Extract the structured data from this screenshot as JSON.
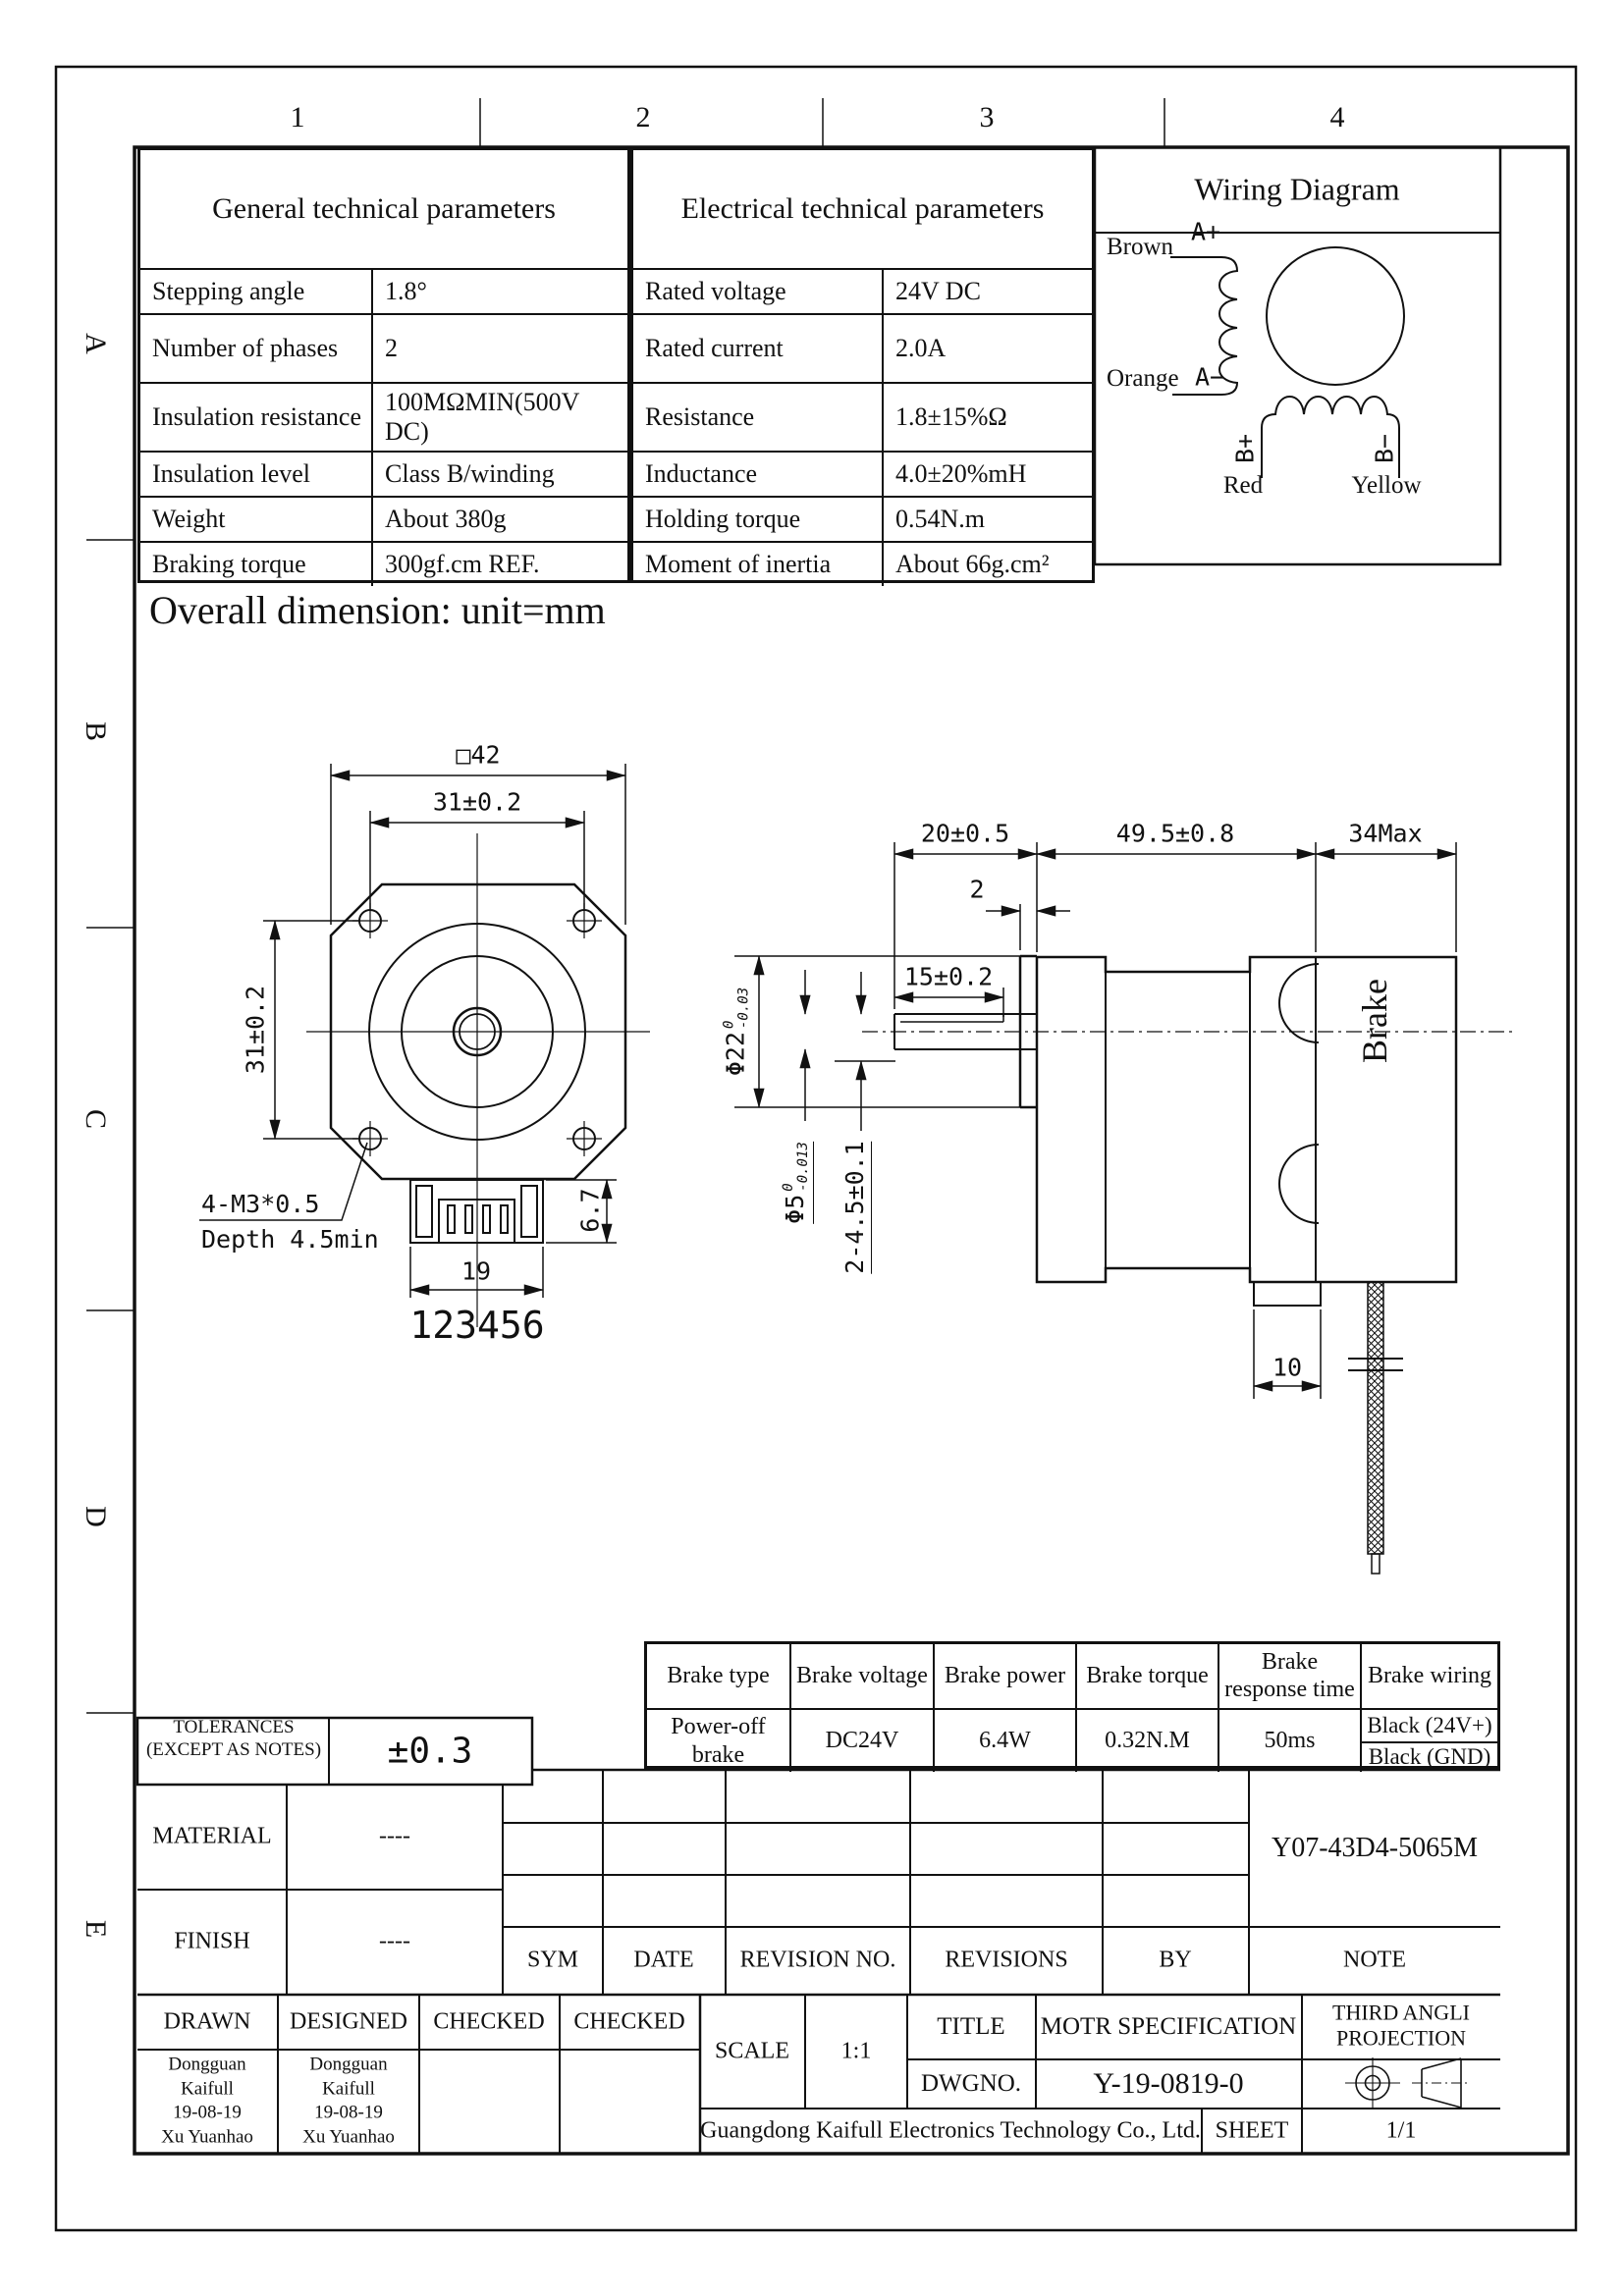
{
  "zones": {
    "cols": [
      "1",
      "2",
      "3",
      "4"
    ],
    "rows": [
      "A",
      "B",
      "C",
      "D",
      "E"
    ]
  },
  "general_table": {
    "title": "General technical parameters",
    "rows": [
      {
        "label": "Stepping angle",
        "value": "1.8°"
      },
      {
        "label": "Number of phases",
        "value": "2"
      },
      {
        "label": "Insulation resistance",
        "value": "100MΩMIN(500V DC)"
      },
      {
        "label": "Insulation level",
        "value": "Class B/winding"
      },
      {
        "label": "Weight",
        "value": "About 380g"
      },
      {
        "label": "Braking torque",
        "value": "300gf.cm REF."
      }
    ]
  },
  "electrical_table": {
    "title": "Electrical technical parameters",
    "rows": [
      {
        "label": "Rated voltage",
        "value": "24V DC"
      },
      {
        "label": "Rated current",
        "value": "2.0A"
      },
      {
        "label": "Resistance",
        "value": "1.8±15%Ω"
      },
      {
        "label": "Inductance",
        "value": "4.0±20%mH"
      },
      {
        "label": "Holding torque",
        "value": "0.54N.m"
      },
      {
        "label": "Moment of inertia",
        "value": "About 66g.cm²"
      }
    ]
  },
  "wiring": {
    "title": "Wiring Diagram",
    "brown": "Brown",
    "orange": "Orange",
    "red": "Red",
    "yellow": "Yellow",
    "a_plus": "A+",
    "a_minus": "A−",
    "b_plus": "B+",
    "b_minus": "B−"
  },
  "dims": {
    "heading": "Overall dimension: unit=mm",
    "front": {
      "square": "□42",
      "width_holes": "31±0.2",
      "height_holes": "31±0.2",
      "screw": "4-M3*0.5",
      "screw_depth": "Depth 4.5min",
      "conn_width": "19",
      "conn_height": "6.7",
      "pins": "123456"
    },
    "side": {
      "shaft_len": "20±0.5",
      "body_len": "49.5±0.8",
      "brake_len": "34Max",
      "boss_len": "2",
      "flat_len": "15±0.2",
      "boss_dia": "Φ22",
      "boss_dia_hi": "0",
      "boss_dia_lo": "-0.03",
      "shaft_dia": "Φ5",
      "shaft_dia_hi": "0",
      "shaft_dia_lo": "-0.013",
      "holes": "2-4.5±0.1",
      "wire_exit": "10",
      "brake_label": "Brake"
    }
  },
  "brake_table": {
    "headers": [
      "Brake type",
      "Brake voltage",
      "Brake power",
      "Brake torque",
      "Brake response time",
      "Brake wiring"
    ],
    "type": "Power-off brake",
    "voltage": "DC24V",
    "power": "6.4W",
    "torque": "0.32N.M",
    "response": "50ms",
    "wiring_1": "Black (24V+)",
    "wiring_2": "Black (GND)"
  },
  "title_block": {
    "tolerances_label_1": "TOLERANCES",
    "tolerances_label_2": "(EXCEPT AS NOTES)",
    "tolerances_value": "±0.3",
    "material_label": "MATERIAL",
    "material_value": "----",
    "finish_label": "FINISH",
    "finish_value": "----",
    "sym": "SYM",
    "date": "DATE",
    "revision_no": "REVISION NO.",
    "revisions": "REVISIONS",
    "by": "BY",
    "note": "NOTE",
    "part_number": "Y07-43D4-5065M",
    "drawn_label": "DRAWN",
    "designed_label": "DESIGNED",
    "checked1_label": "CHECKED",
    "checked2_label": "CHECKED",
    "drawn_1": "Dongguan",
    "drawn_2": "Kaifull",
    "drawn_3": "19-08-19",
    "drawn_4": "Xu Yuanhao",
    "designed_1": "Dongguan",
    "designed_2": "Kaifull",
    "designed_3": "19-08-19",
    "designed_4": "Xu Yuanhao",
    "scale_label": "SCALE",
    "scale_value": "1:1",
    "title_label": "TITLE",
    "title_value": "MOTR SPECIFICATION",
    "dwg_label": "DWGNO.",
    "dwg_value": "Y-19-0819-0",
    "projection_1": "THIRD ANGLI",
    "projection_2": "PROJECTION",
    "company": "Guangdong Kaifull Electronics Technology Co., Ltd.",
    "sheet_label": "SHEET",
    "sheet_value": "1/1"
  }
}
